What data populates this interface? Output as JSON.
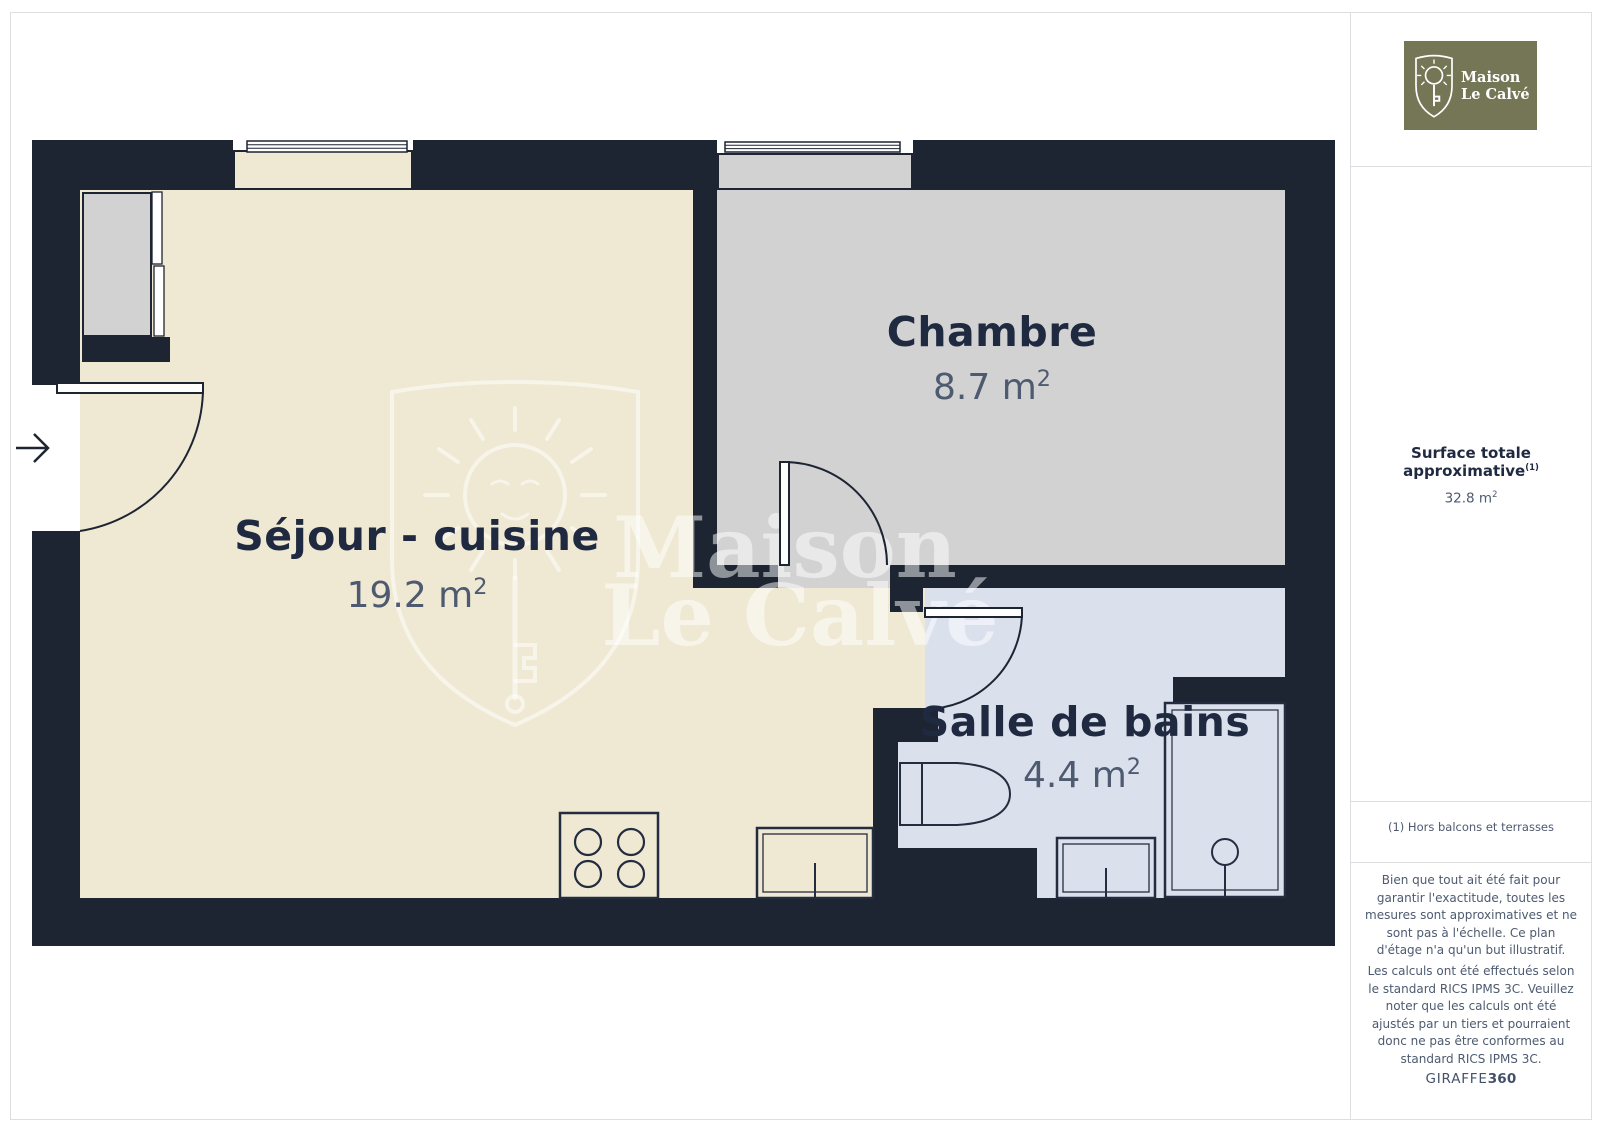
{
  "branding": {
    "logo_line1": "Maison",
    "logo_line2": "Le Calvé",
    "watermark_line1": "Maison",
    "watermark_line2": "Le Calvé"
  },
  "rooms": [
    {
      "name": "Séjour - cuisine",
      "area": "19.2 m",
      "area_sup": "2"
    },
    {
      "name": "Chambre",
      "area": "8.7 m",
      "area_sup": "2"
    },
    {
      "name": "Salle de bains",
      "area": "4.4 m",
      "area_sup": "2"
    }
  ],
  "sidebar": {
    "surface_title": "Surface totale approximative",
    "surface_sup": "(1)",
    "surface_value": "32.8 m",
    "surface_value_sup": "2",
    "footnote": "(1) Hors balcons et terrasses",
    "disclaimer1": "Bien que tout ait été fait pour garantir l'exactitude, toutes les mesures sont approximatives et ne sont pas à l'échelle. Ce plan d'étage n'a qu'un but illustratif.",
    "disclaimer2": "Les calculs ont été effectués selon le standard RICS IPMS 3C. Veuillez noter que les calculs ont été ajustés par un tiers et pourraient donc ne pas être conformes au standard RICS IPMS 3C.",
    "brand_footer_regular": "GIRAFFE",
    "brand_footer_bold": "360"
  },
  "colors": {
    "wall": "#1d2432",
    "sejour_floor": "#efe8d3",
    "chambre_floor": "#d2d2d2",
    "bath_floor": "#dbe0ed",
    "logo_olive": "#747656",
    "ink": "#1f2940",
    "muted": "#4d5a70"
  }
}
